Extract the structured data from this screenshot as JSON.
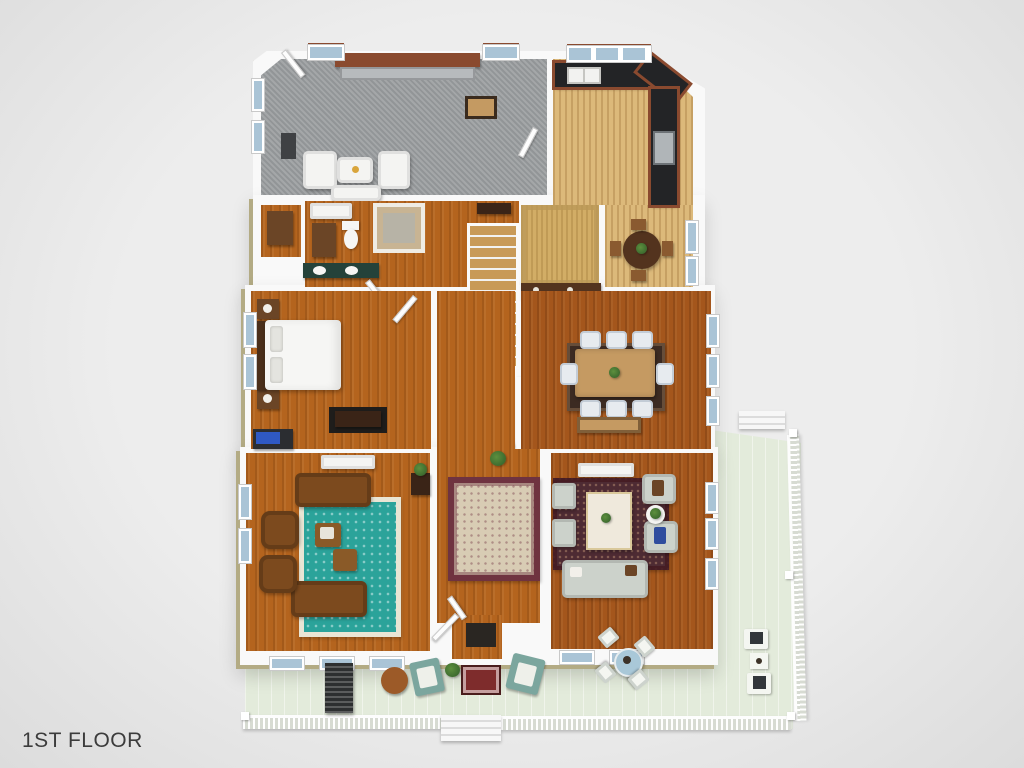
{
  "title": {
    "floor_label": "1ST FLOOR"
  },
  "colors": {
    "background": "#ededed",
    "vignette": "#dcdcdc",
    "wall": "#f9f9f9",
    "khaki": "#b3ab84",
    "brick": "#8a4a2f",
    "carpet": "#9da0a2",
    "wood_light": "#dcb97a",
    "wood_pantry": "#d2ad66",
    "wood_main": "#b4641e",
    "wood_dark": "#a4561c",
    "deck": "#e3ebdb",
    "counter_black": "#232426",
    "steel": "#b0b5b8",
    "rug_teal": "#2ba39a",
    "rug_cream": "#e9e5d4",
    "rug_oriental_border": "#6f3340",
    "rug_oriental_field": "#d8ccb4",
    "rug_family": "#4e2b33",
    "leather": "#7c4a1e",
    "fabric_gray": "#ccd2cb",
    "table_wood": "#c59a62",
    "dark_wood": "#53331e",
    "white_furn": "#f4f4f2",
    "teal_chair": "#7ba69e",
    "mat_red": "#7e2c2c",
    "glider_dark": "#2d2f30",
    "plant_green": "#3d6b2f",
    "window_blue": "#aac4d6",
    "text": "#3c3c3c"
  }
}
